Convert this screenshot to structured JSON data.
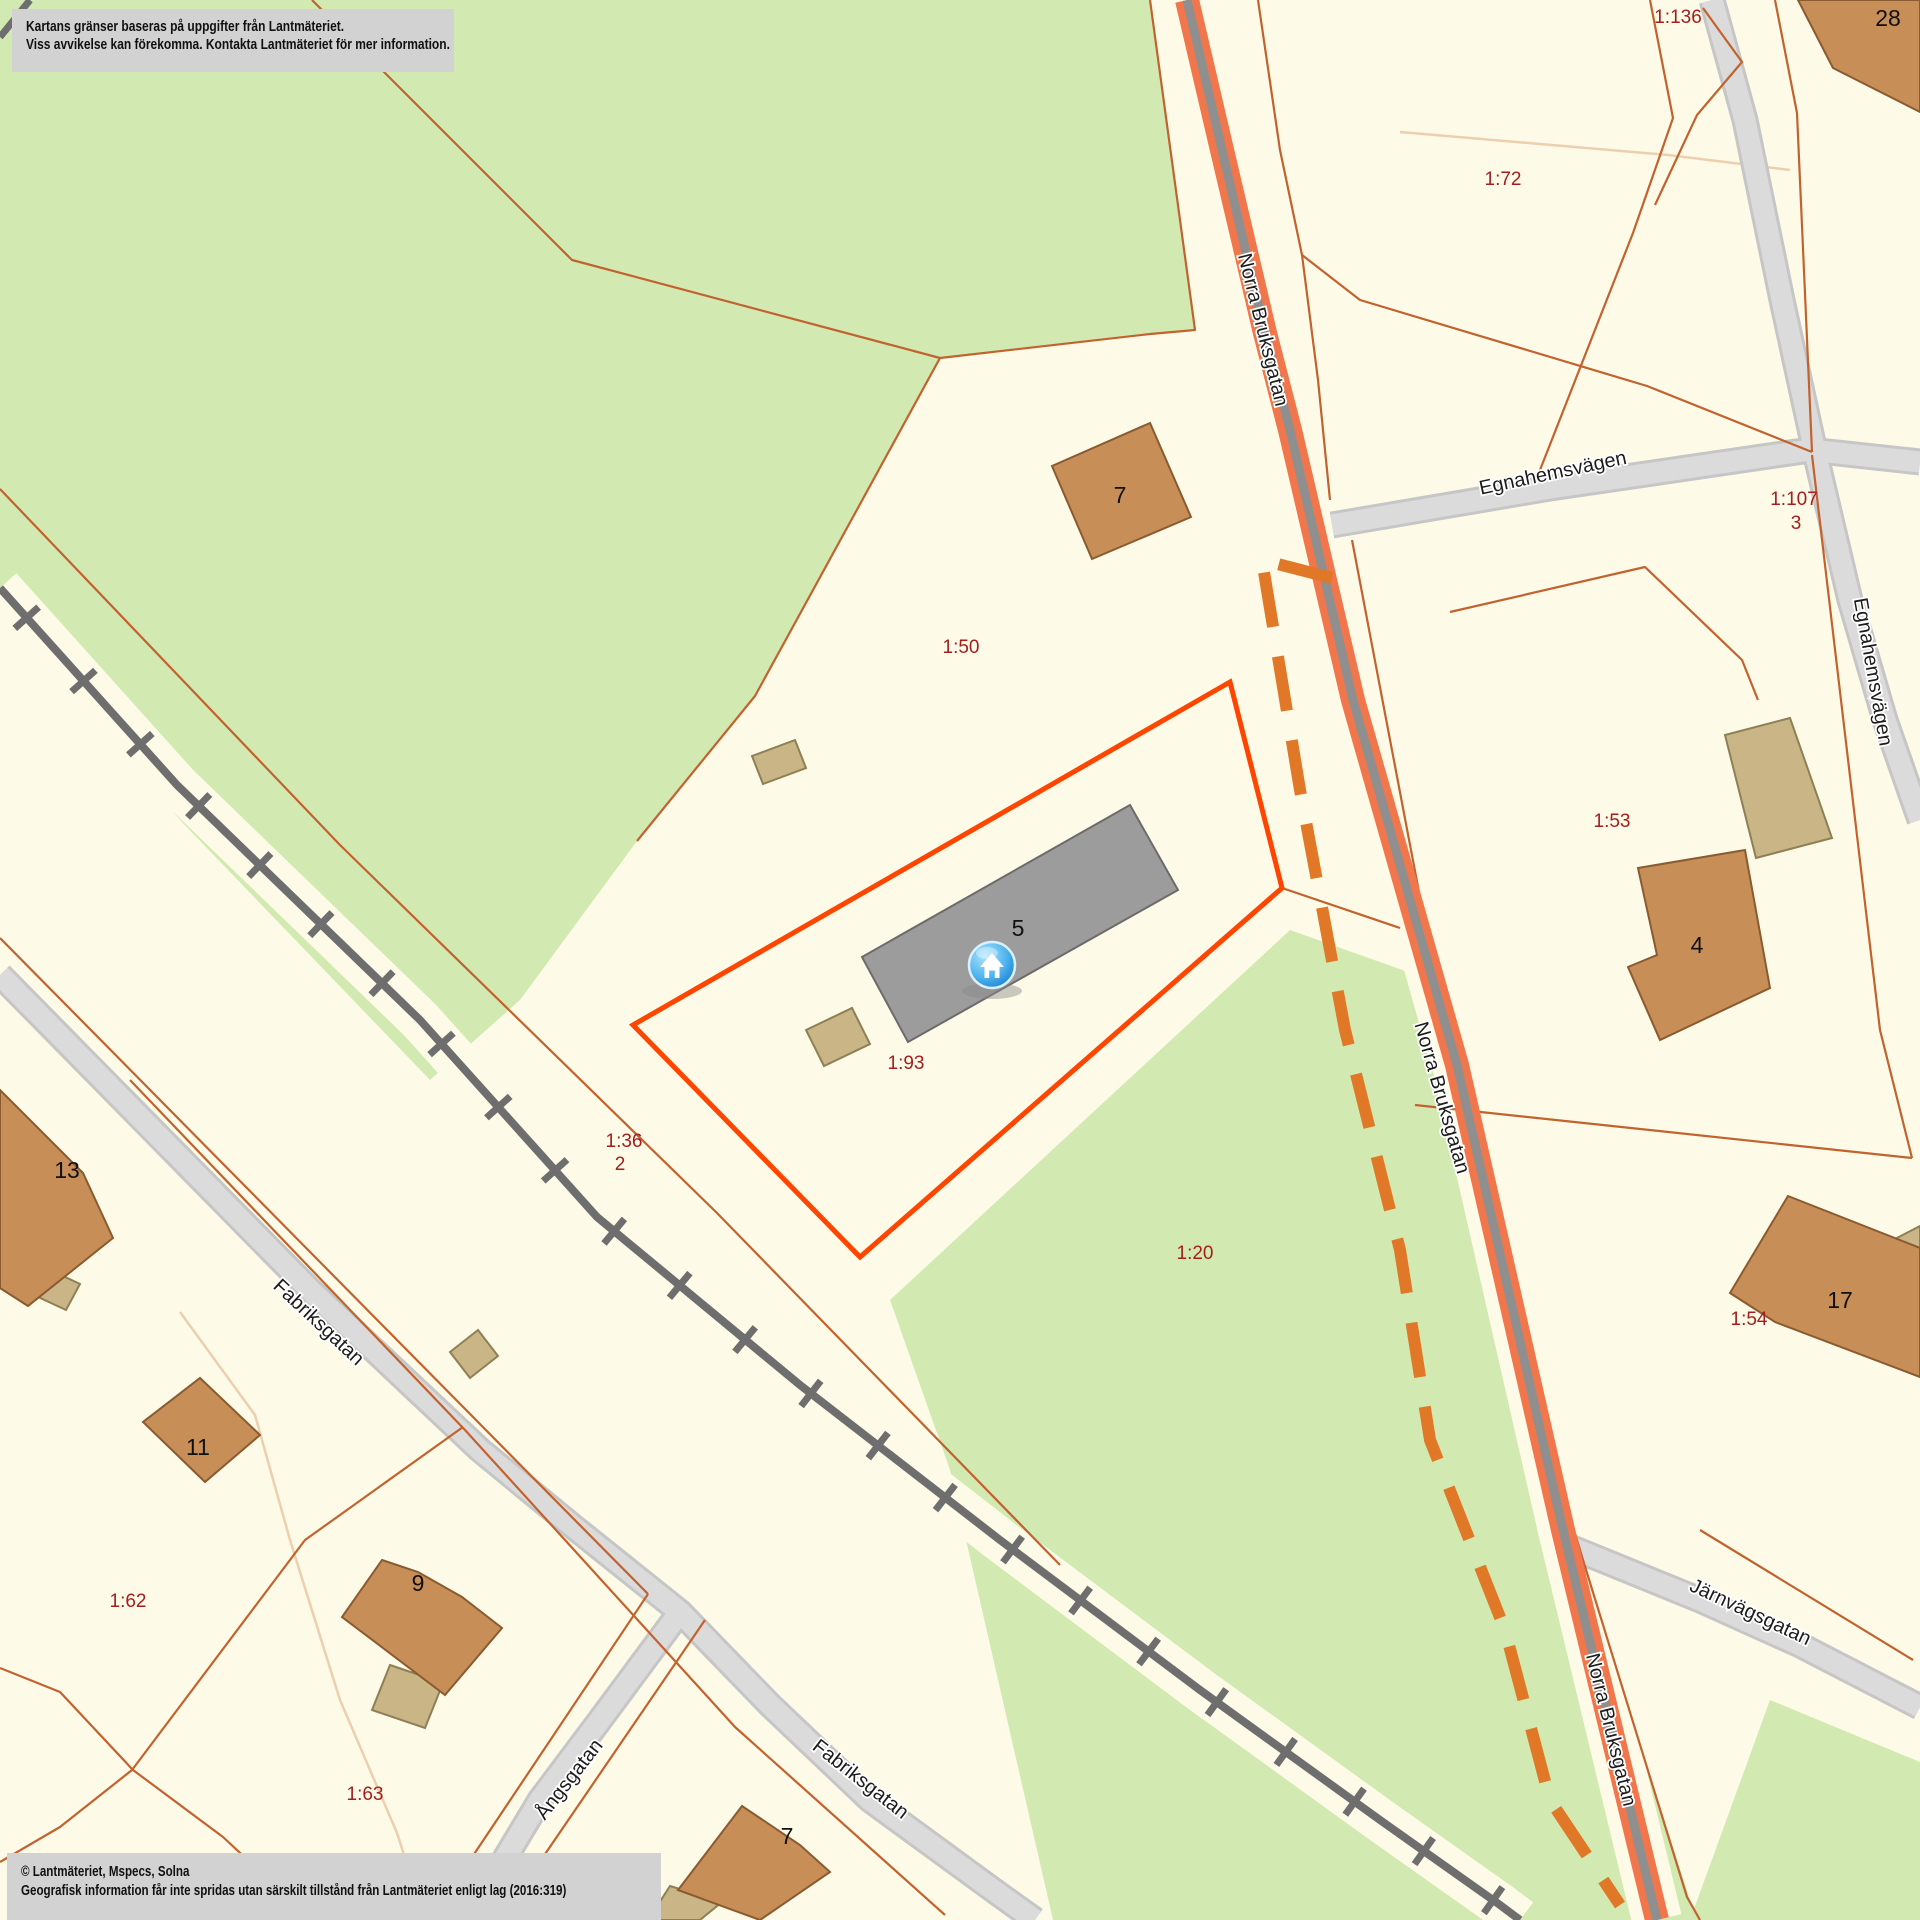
{
  "disclaimer": {
    "line1": "Kartans gränser baseras på uppgifter från Lantmäteriet.",
    "line2": "Viss avvikelse kan förekomma. Kontakta Lantmäteriet för mer information."
  },
  "copyright": {
    "line1": "© Lantmäteriet, Mspecs, Solna",
    "line2": "Geografisk information får inte spridas utan särskilt tillstånd från Lantmäteriet enligt lag (2016:319)"
  },
  "map": {
    "colors": {
      "background": "#FDFBE7",
      "vegetation": "#D2EAB2",
      "road_fill": "#DBDBDB",
      "road_edge": "#C6C6C6",
      "main_road_casing": "#F2764B",
      "main_road_core": "#8F8F8F",
      "railway": "#6E6E6E",
      "parcel_boundary": "#C2622E",
      "parcel_boundary_faint": "#EDCFB0",
      "municipal_dash": "#E07828",
      "selection_outline": "#FF4500",
      "parcel_label": "#A51E1E",
      "building_fill": "#C78E58",
      "building_annex_fill": "#C9B586",
      "selected_building_fill": "#9C9C9C",
      "marker_blue": "#1E88D8",
      "info_box_bg": "#D2D2D2"
    },
    "street_labels": [
      {
        "text": "Norra Bruksgatan",
        "x": 1262,
        "y": 330,
        "rotate": 76
      },
      {
        "text": "Norra Bruksgatan",
        "x": 1441,
        "y": 1098,
        "rotate": 74
      },
      {
        "text": "Norra Bruksgatan",
        "x": 1610,
        "y": 1730,
        "rotate": 76
      },
      {
        "text": "Egnahemsvägen",
        "x": 1553,
        "y": 474,
        "rotate": -12
      },
      {
        "text": "Egnahemsvägen",
        "x": 1872,
        "y": 672,
        "rotate": 80
      },
      {
        "text": "Fabriksgatan",
        "x": 318,
        "y": 1323,
        "rotate": 43
      },
      {
        "text": "Fabriksgatan",
        "x": 860,
        "y": 1780,
        "rotate": 38
      },
      {
        "text": "Ångsgatan",
        "x": 570,
        "y": 1780,
        "rotate": -52
      },
      {
        "text": "Järnvägsgatan",
        "x": 1750,
        "y": 1613,
        "rotate": 25
      }
    ],
    "parcel_labels": [
      {
        "text": "1:136",
        "x": 1678,
        "y": 18
      },
      {
        "text": "1:72",
        "x": 1503,
        "y": 180
      },
      {
        "text": "1:107",
        "x": 1794,
        "y": 500
      },
      {
        "text": "3",
        "x": 1796,
        "y": 524
      },
      {
        "text": "1:50",
        "x": 961,
        "y": 648
      },
      {
        "text": "1:93",
        "x": 906,
        "y": 1064
      },
      {
        "text": "1:36",
        "x": 624,
        "y": 1142
      },
      {
        "text": "2",
        "x": 620,
        "y": 1165
      },
      {
        "text": "1:20",
        "x": 1195,
        "y": 1254
      },
      {
        "text": "1:53",
        "x": 1612,
        "y": 822
      },
      {
        "text": "1:54",
        "x": 1749,
        "y": 1320
      },
      {
        "text": "1:62",
        "x": 128,
        "y": 1602
      },
      {
        "text": "1:63",
        "x": 365,
        "y": 1795
      }
    ],
    "building_labels": [
      {
        "text": "28",
        "x": 1888,
        "y": 20
      },
      {
        "text": "7",
        "x": 1120,
        "y": 497
      },
      {
        "text": "5",
        "x": 1018,
        "y": 930
      },
      {
        "text": "4",
        "x": 1697,
        "y": 947
      },
      {
        "text": "17",
        "x": 1840,
        "y": 1302
      },
      {
        "text": "13",
        "x": 67,
        "y": 1172
      },
      {
        "text": "11",
        "x": 198,
        "y": 1449
      },
      {
        "text": "9",
        "x": 418,
        "y": 1585
      },
      {
        "text": "7",
        "x": 787,
        "y": 1838
      }
    ],
    "marker": {
      "name": "selected-property-marker",
      "x": 992,
      "y": 965
    }
  }
}
